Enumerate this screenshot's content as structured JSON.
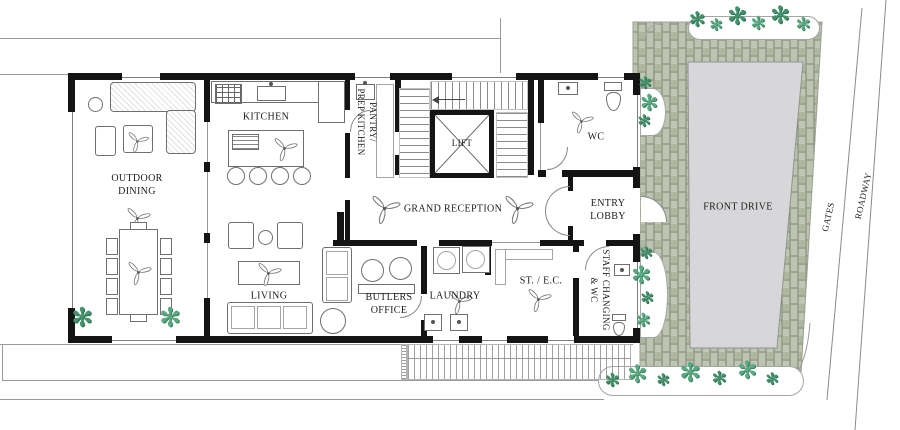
{
  "rooms": {
    "outdoor_dining": "OUTDOOR\nDINING",
    "kitchen": "KITCHEN",
    "pantry": "PANTRY/\nPREP KITCHEN",
    "lift": "LIFT",
    "wc": "WC",
    "grand_reception": "GRAND RECEPTION",
    "entry_lobby": "ENTRY\nLOBBY",
    "living": "LIVING",
    "butlers_office": "BUTLERS\nOFFICE",
    "laundry": "LAUNDRY",
    "st_ec": "ST. / E.C.",
    "staff_changing": "STAFF CHANGING\n& WC"
  },
  "site": {
    "front_drive": "FRONT DRIVE",
    "gates": "GATES",
    "roadway": "ROADWAY"
  },
  "icons": {
    "plant": "✻"
  },
  "colors": {
    "wall": "#141414",
    "paver": "#b6bdaa",
    "paver_joint": "#848c78",
    "driveway": "#d7d7d9",
    "plant_green": "#43926c",
    "line_gray": "#9a9a9a"
  }
}
